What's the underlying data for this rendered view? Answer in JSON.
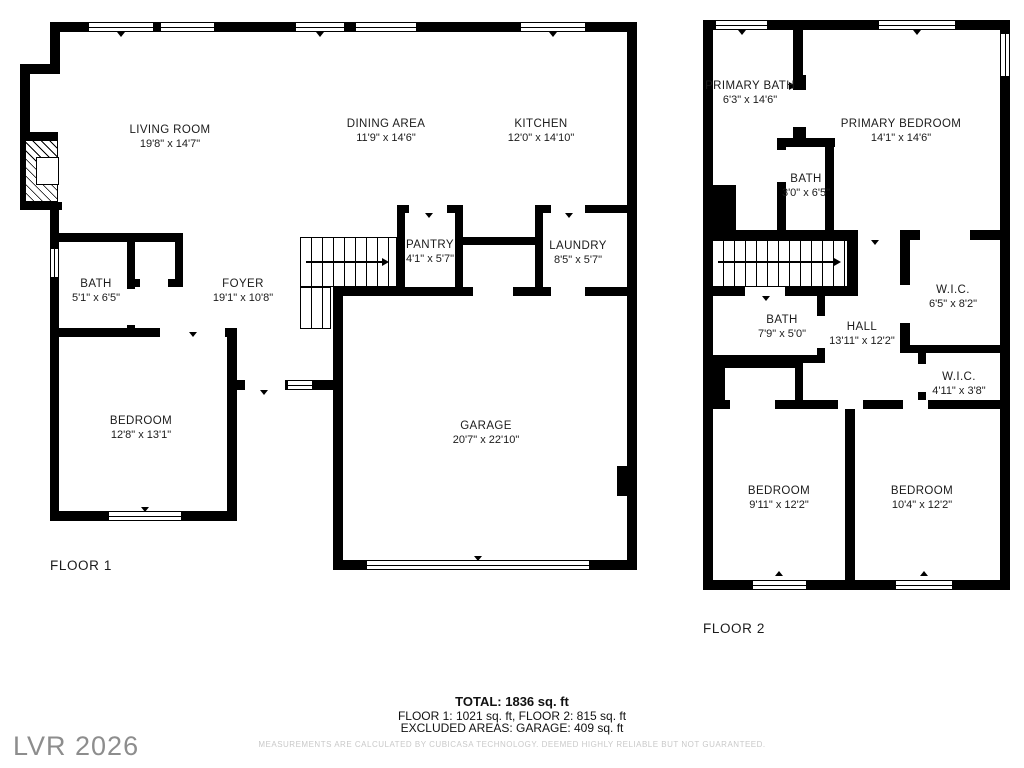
{
  "watermark": {
    "text": "LVR 2026"
  },
  "floor1": {
    "label": "FLOOR 1",
    "rooms": [
      {
        "name": "LIVING ROOM",
        "dims": "19'8\" x 14'7\""
      },
      {
        "name": "DINING AREA",
        "dims": "11'9\" x 14'6\""
      },
      {
        "name": "KITCHEN",
        "dims": "12'0\" x 14'10\""
      },
      {
        "name": "BATH",
        "dims": "5'1\" x 6'5\""
      },
      {
        "name": "FOYER",
        "dims": "19'1\" x 10'8\""
      },
      {
        "name": "PANTRY",
        "dims": "4'1\" x 5'7\""
      },
      {
        "name": "LAUNDRY",
        "dims": "8'5\" x 5'7\""
      },
      {
        "name": "BEDROOM",
        "dims": "12'8\" x 13'1\""
      },
      {
        "name": "GARAGE",
        "dims": "20'7\" x 22'10\""
      }
    ]
  },
  "floor2": {
    "label": "FLOOR 2",
    "rooms": [
      {
        "name": "PRIMARY BATH",
        "dims": "6'3\" x 14'6\""
      },
      {
        "name": "PRIMARY BEDROOM",
        "dims": "14'1\" x 14'6\""
      },
      {
        "name": "BATH",
        "dims": "3'0\" x 6'5\""
      },
      {
        "name": "W.I.C.",
        "dims": "6'5\" x 8'2\""
      },
      {
        "name": "BATH",
        "dims": "7'9\" x 5'0\""
      },
      {
        "name": "HALL",
        "dims": "13'11\" x 12'2\""
      },
      {
        "name": "W.I.C.",
        "dims": "4'11\" x 3'8\""
      },
      {
        "name": "BEDROOM",
        "dims": "9'11\" x 12'2\""
      },
      {
        "name": "BEDROOM",
        "dims": "10'4\" x 12'2\""
      }
    ]
  },
  "summary": {
    "total": "TOTAL: 1836 sq. ft",
    "floors": "FLOOR 1: 1021 sq. ft, FLOOR 2: 815 sq. ft",
    "excluded": "EXCLUDED AREAS: GARAGE: 409 sq. ft",
    "disclaimer": "MEASUREMENTS ARE CALCULATED BY CUBICASA TECHNOLOGY. DEEMED HIGHLY RELIABLE BUT NOT GUARANTEED."
  },
  "colors": {
    "wall": "#000000",
    "text": "#1b1b1b",
    "muted": "#c9c9c9",
    "watermark": "#8d8d8d"
  }
}
